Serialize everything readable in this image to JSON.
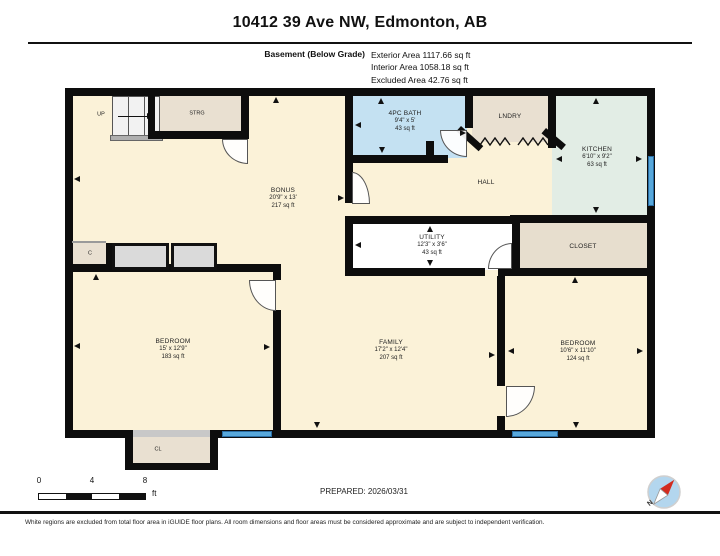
{
  "header": {
    "title": "10412 39 Ave NW, Edmonton, AB",
    "floor_label": "Basement (Below Grade)",
    "areas": {
      "exterior": "Exterior Area 1117.66 sq ft",
      "interior": "Interior Area 1058.18 sq ft",
      "excluded": "Excluded Area 42.76 sq ft"
    }
  },
  "rooms": {
    "bonus": {
      "name": "BONUS",
      "dims": "20'9\" x 13'",
      "area": "217 sq ft"
    },
    "bath": {
      "name": "4PC BATH",
      "dims": "9'4\" x 5'",
      "area": "43 sq ft"
    },
    "laundry": {
      "name": "LNDRY"
    },
    "kitchen": {
      "name": "KITCHEN",
      "dims": "6'10\" x 9'2\"",
      "area": "63 sq ft"
    },
    "hall": {
      "name": "HALL"
    },
    "utility": {
      "name": "UTILITY",
      "dims": "12'3\" x 3'6\"",
      "area": "43 sq ft"
    },
    "closet": {
      "name": "CLOSET"
    },
    "storage": {
      "name": "STRG"
    },
    "stairs_up": {
      "name": "UP"
    },
    "closet_c": {
      "name": "C"
    },
    "closet_cl": {
      "name": "CL"
    },
    "bedroom_left": {
      "name": "BEDROOM",
      "dims": "15' x 12'9\"",
      "area": "183 sq ft"
    },
    "family": {
      "name": "FAMILY",
      "dims": "17'2\" x 12'4\"",
      "area": "207 sq ft"
    },
    "bedroom_right": {
      "name": "BEDROOM",
      "dims": "10'6\" x 11'10\"",
      "area": "124 sq ft"
    }
  },
  "scale_bar": {
    "ticks": [
      "0",
      "4",
      "8"
    ],
    "unit": "ft"
  },
  "compass": {
    "label": "N"
  },
  "footer": {
    "prepared": "PREPARED: 2026/03/31",
    "disclaimer": "White regions are excluded from total floor area in iGUIDE floor plans. All room dimensions and floor areas must be considered approximate and are subject to independent verification."
  },
  "colors": {
    "wall": "#0d0d0d",
    "floor_cream": "#FBF2D8",
    "bath_blue": "#C4E1F2",
    "kitchen_green": "#E2EDE5",
    "tan": "#E9E0D1",
    "window_blue": "#58A8DB"
  }
}
